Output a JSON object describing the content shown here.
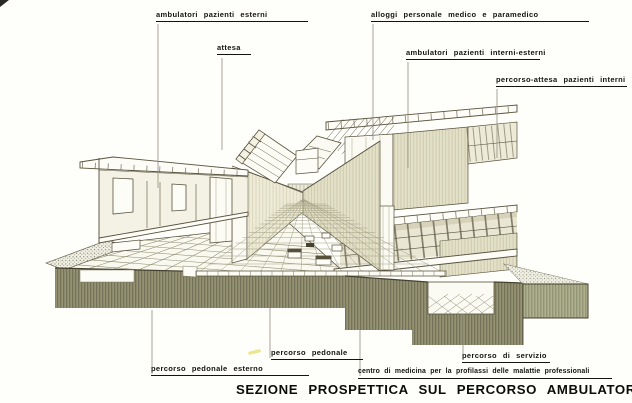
{
  "title": "SEZIONE PROSPETTICA SUL PERCORSO AMBULATORIALE",
  "labels": {
    "ambulatori_pazienti_esterni": "ambulatori pazienti esterni",
    "attesa": "attesa",
    "alloggi_personale": "alloggi personale medico e paramedico",
    "ambulatori_interni_esterni": "ambulatori pazienti interni-esterni",
    "percorso_attesa_interni": "percorso-attesa pazienti interni",
    "percorso_pedonale": "percorso pedonale",
    "percorso_pedonale_esterno": "percorso pedonale esterno",
    "percorso_di_servizio": "percorso di servizio",
    "centro_di_medicina": "centro di medicina per la profilassi delle malattie professionali"
  },
  "colors": {
    "ink": "#57523d",
    "ground_olive": "#8f8c6d",
    "ground_light": "#a9ab88",
    "wall_tint": "#e7e4cf",
    "label_text": "#15130f",
    "highlight_yellow": "#e9e077",
    "background": "#fefefb"
  }
}
